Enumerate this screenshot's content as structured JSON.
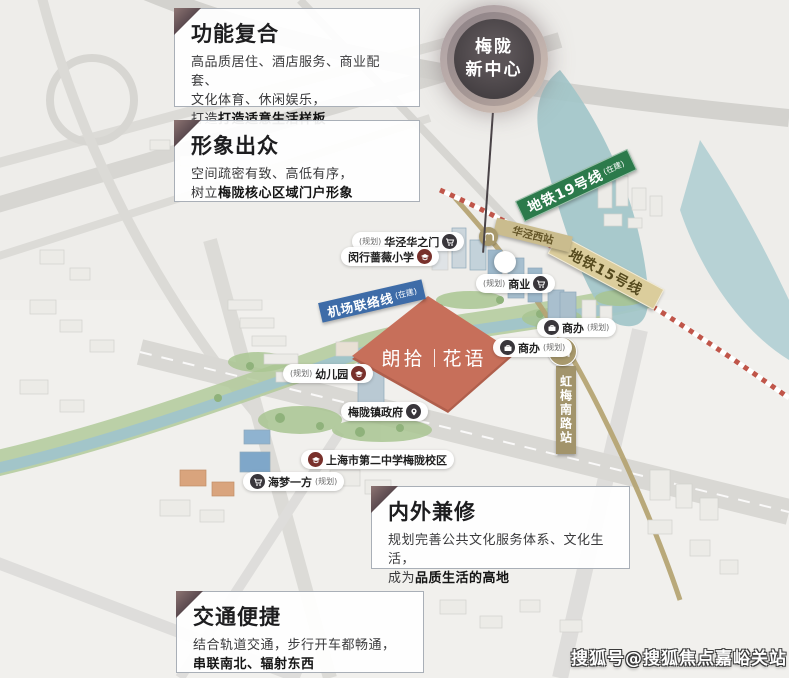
{
  "badge": {
    "line1": "梅陇",
    "line2": "新中心"
  },
  "callouts": {
    "c1": {
      "title": "功能复合",
      "l1": "高品质居住、酒店服务、商业配套、",
      "l2": "文化体育、休闲娱乐，",
      "l3a": "打造",
      "l3b": "打造适意生活样板"
    },
    "c2": {
      "title": "形象出众",
      "l1": "空间疏密有致、高低有序，",
      "l2a": "树立",
      "l2b": "梅陇核心区域门户形象"
    },
    "c3": {
      "title": "内外兼修",
      "l1": "规划完善公共文化服务体系、文化生活，",
      "l2a": "成为",
      "l2b": "品质生活的高地"
    },
    "c4": {
      "title": "交通便捷",
      "l1": "结合轨道交通，步行开车都畅通，",
      "l2b": "串联南北、辐射东西"
    }
  },
  "banners": {
    "metro19": {
      "text": "地铁19号线",
      "suffix": "(在建)"
    },
    "metro15": {
      "text": "地铁15号线"
    },
    "airport_link": {
      "text": "机场联络线",
      "suffix": "(在建)"
    },
    "huajing_west": {
      "text": "华泾西站"
    },
    "hongmei_station": {
      "text": "虹梅南路站"
    }
  },
  "pois": {
    "huajing_gate": {
      "prefix": "(规划)",
      "text": "华泾华之门"
    },
    "qiangwei_school": {
      "text": "闵行蔷薇小学"
    },
    "shangye": {
      "prefix": "(规划)",
      "text": "商业"
    },
    "shangban_upper": {
      "text": "商办",
      "suffix": "(规划)"
    },
    "shangban_lower": {
      "text": "商办",
      "suffix": "(规划)"
    },
    "kindergarten": {
      "prefix": "(规划)",
      "text": "幼儿园"
    },
    "government": {
      "text": "梅陇镇政府"
    },
    "no2_school": {
      "text": "上海市第二中学梅陇校区"
    },
    "haimeng": {
      "text": "海梦一方",
      "suffix": "(规划)"
    }
  },
  "project": {
    "name_left": "朗拾",
    "name_right": "花语"
  },
  "watermark": "搜狐号@搜狐焦点嘉峪关站",
  "colors": {
    "metro19_green": "#2c7a4b",
    "metro15_tan": "#dbcd9c",
    "airport_blue": "#3e6ca8",
    "station_gold": "#a2946b",
    "project_red": "#c76f5a",
    "badge_dark": "#433e41",
    "river_teal": "#a2c5c9"
  }
}
